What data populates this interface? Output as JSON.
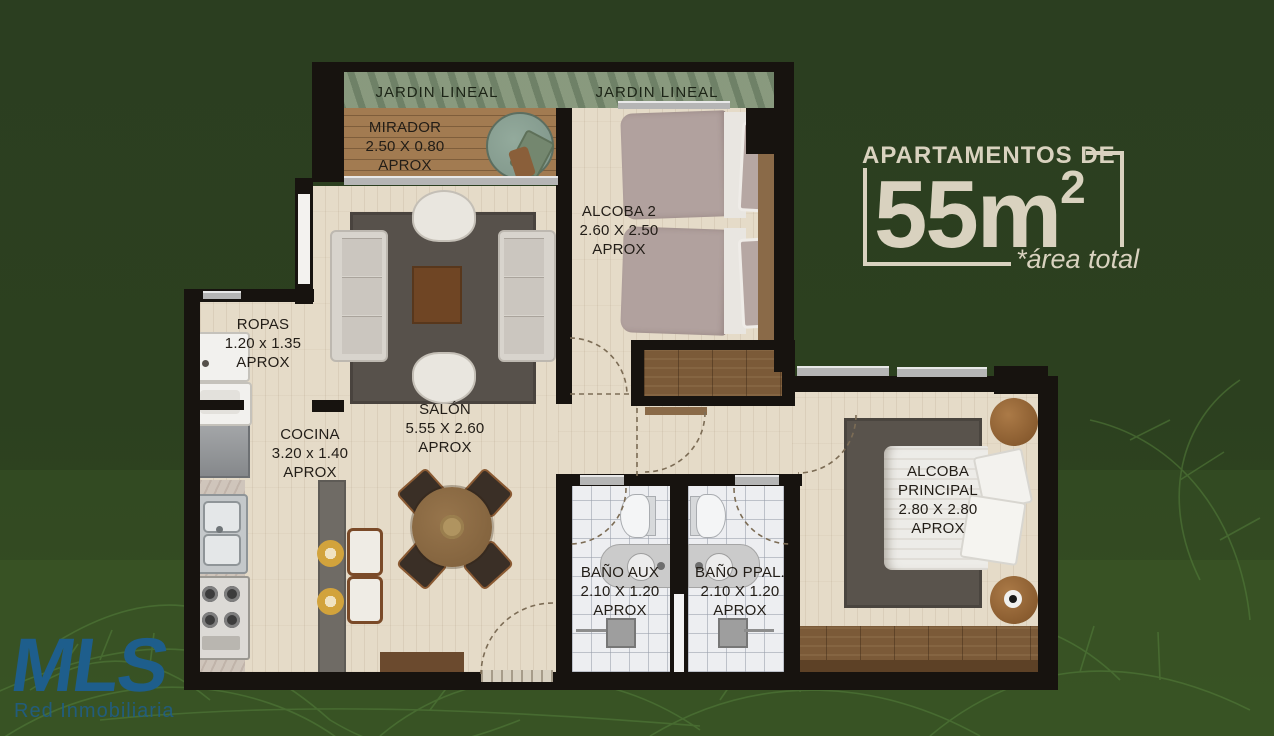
{
  "headline": {
    "line1": "APARTAMENTOS DE",
    "area_value": "55m",
    "area_sup": "2",
    "footnote": "*área total",
    "color": "#d9d2bf"
  },
  "logo": {
    "name": "MLS",
    "tagline": "Red Inmobiliaria",
    "color": "#1e5e8c"
  },
  "garden": {
    "label_left": "JARDIN LINEAL",
    "label_right": "JARDIN LINEAL"
  },
  "rooms": {
    "mirador": {
      "name": "MIRADOR",
      "dims": "2.50 X 0.80",
      "aprox": "APROX"
    },
    "alcoba2": {
      "name": "ALCOBA 2",
      "dims": "2.60 X 2.50",
      "aprox": "APROX"
    },
    "ropas": {
      "name": "ROPAS",
      "dims": "1.20 x 1.35",
      "aprox": "APROX"
    },
    "salon": {
      "name": "SALÓN",
      "dims": "5.55 X 2.60",
      "aprox": "APROX"
    },
    "cocina": {
      "name": "COCINA",
      "dims": "3.20 x 1.40",
      "aprox": "APROX"
    },
    "bano_aux": {
      "name": "BAÑO AUX",
      "dims": "2.10 X 1.20",
      "aprox": "APROX"
    },
    "bano_ppal": {
      "name": "BAÑO PPAL.",
      "dims": "2.10 X 1.20",
      "aprox": "APROX"
    },
    "alcoba_principal": {
      "name": "ALCOBA PRINCIPAL",
      "dims": "2.80 X 2.80",
      "aprox": "APROX"
    }
  },
  "colors": {
    "background_green": "#2b3e20",
    "leaf_line": "#55803c",
    "wall_black": "#17130f",
    "wood_floor": "#e5dbc8",
    "deck_wood": "#a27b51",
    "garden_strip": "#88997e",
    "tile": "#edeef1",
    "rug_gray": "#57514b",
    "accent_cream": "#d9d2bf",
    "logo_blue": "#1e5e8c"
  }
}
